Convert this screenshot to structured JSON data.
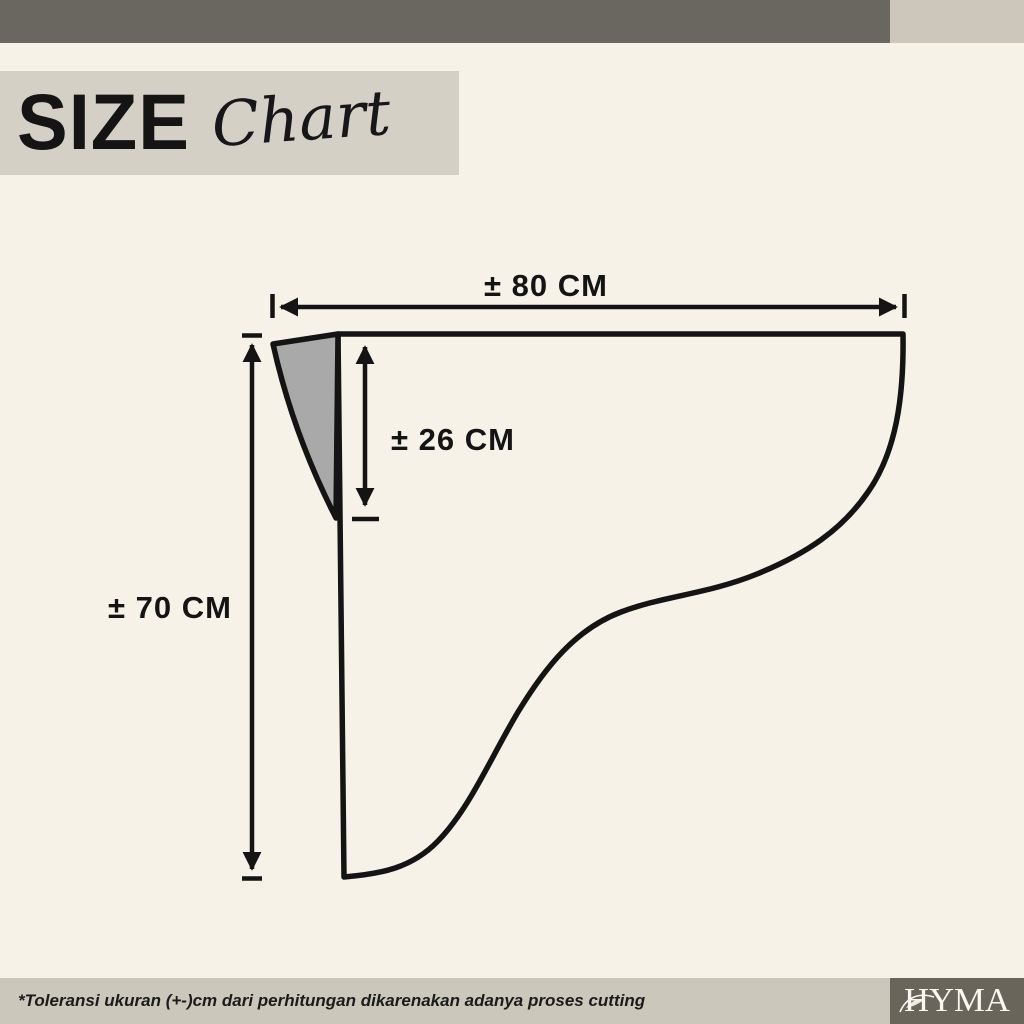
{
  "page": {
    "background": "#f7f2e8"
  },
  "header": {
    "top_bar_color": "#6a6660",
    "accent_block_color": "#ccc7ba",
    "title_block_color": "#d5d0c5",
    "title_main": "SIZE",
    "title_script": "Chart"
  },
  "diagram": {
    "line_color": "#141414",
    "gusset_fill": "#a9a9a9",
    "width_label": "± 80 CM",
    "drop_label": "± 26 CM",
    "height_label": "± 70 CM"
  },
  "footer": {
    "bar_color": "#cbc7ba",
    "logo_block_color": "#6a655b",
    "note": "*Toleransi ukuran (+-)cm dari perhitungan dikarenakan adanya proses cutting",
    "brand": "HYMA"
  }
}
